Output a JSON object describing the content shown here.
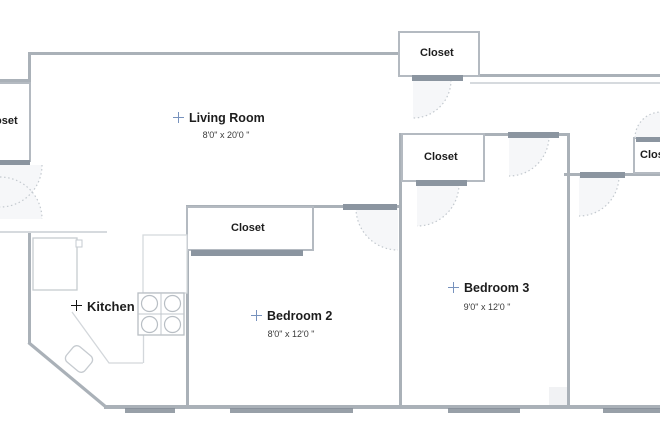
{
  "plan": {
    "type": "floor-plan",
    "marker_glyph": "+",
    "colors": {
      "wall": "#aab1b8",
      "door_header": "#8b95a0",
      "window_marker": "#98a0a8",
      "room_marker_accent": "#7792bd",
      "kitchen_marker": "#141414",
      "label_text": "#1d1d1d"
    },
    "rooms": {
      "living_room": {
        "label": "Living Room",
        "dimensions": "8'0\" x 20'0 \""
      },
      "kitchen": {
        "label": "Kitchen"
      },
      "bedroom_2": {
        "label": "Bedroom 2",
        "dimensions": "8'0\" x 12'0 \""
      },
      "bedroom_3": {
        "label": "Bedroom 3",
        "dimensions": "9'0\" x 12'0 \""
      }
    },
    "closets": {
      "top": {
        "label": "Closet"
      },
      "left": {
        "label": "Closet"
      },
      "bedroom_2": {
        "label": "Closet"
      },
      "bedroom_3": {
        "label": "Closet"
      },
      "right": {
        "label": "Closet"
      }
    }
  }
}
